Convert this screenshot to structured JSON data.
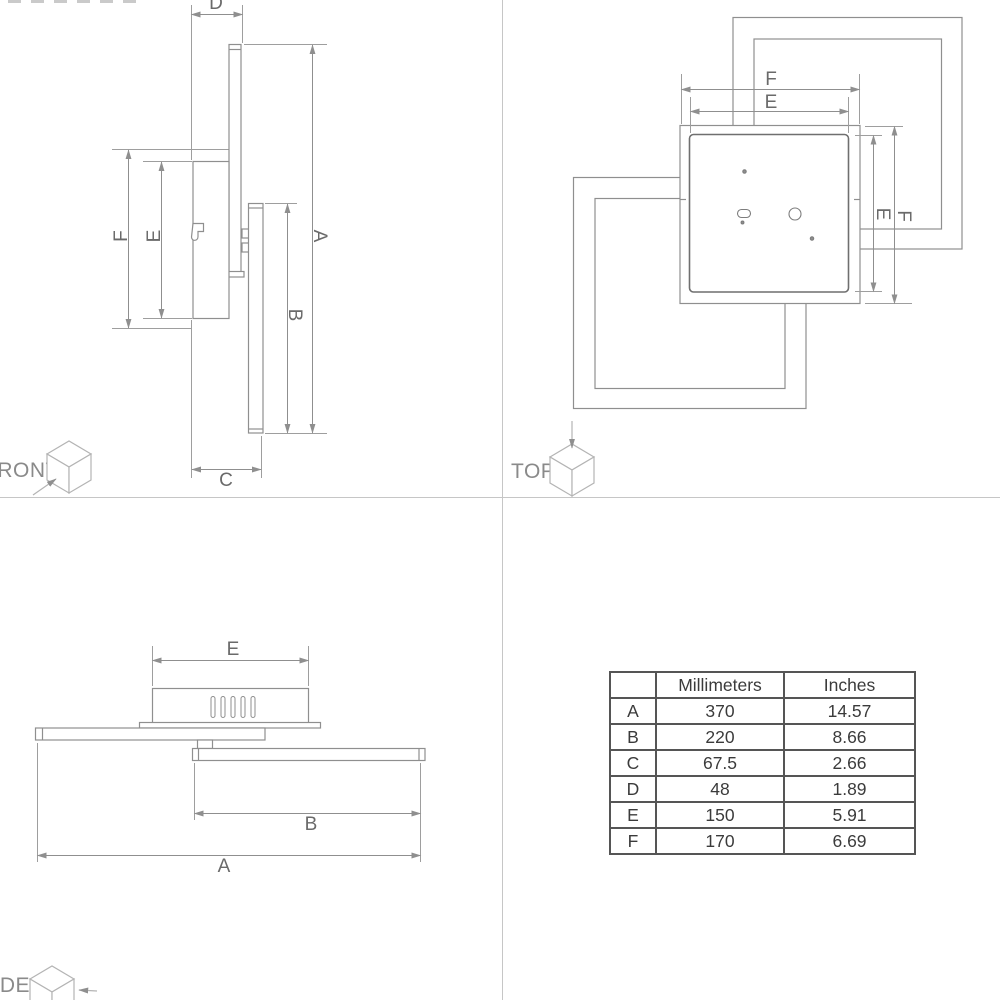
{
  "views": {
    "front": {
      "label": "FRONT",
      "dim_d": "D",
      "dim_f": "F",
      "dim_e": "E",
      "dim_a": "A",
      "dim_b": "B",
      "dim_c": "C"
    },
    "top": {
      "label": "TOP",
      "dim_f_width": "F",
      "dim_e_width": "E",
      "dim_e_height": "E",
      "dim_f_height": "F"
    },
    "side": {
      "label": "SIDE",
      "dim_e": "E",
      "dim_b": "B",
      "dim_a": "A"
    }
  },
  "table": {
    "headers": {
      "dim": "",
      "mm": "Millimeters",
      "in": "Inches"
    },
    "rows": [
      {
        "dim": "A",
        "mm": "370",
        "in": "14.57"
      },
      {
        "dim": "B",
        "mm": "220",
        "in": "8.66"
      },
      {
        "dim": "C",
        "mm": "67.5",
        "in": "2.66"
      },
      {
        "dim": "D",
        "mm": "48",
        "in": "1.89"
      },
      {
        "dim": "E",
        "mm": "150",
        "in": "5.91"
      },
      {
        "dim": "F",
        "mm": "170",
        "in": "6.69"
      }
    ]
  },
  "icons": {
    "front_view": "cube-front-face-arrow-icon",
    "top_view": "cube-top-face-arrow-icon",
    "side_view": "cube-side-face-arrow-icon"
  },
  "colors": {
    "background": "#ffffff",
    "drawing_line": "#8f8f8f",
    "dimension_line": "#9a9a9a",
    "inner_plate_line": "#6f6f6f",
    "dim_text": "#6a6a6a",
    "view_label_text": "#8a8a8a",
    "cube_line": "#b4b4b4",
    "divider_line": "#c6c6c6",
    "table_border": "#555555",
    "table_text": "#3b3b3b"
  }
}
